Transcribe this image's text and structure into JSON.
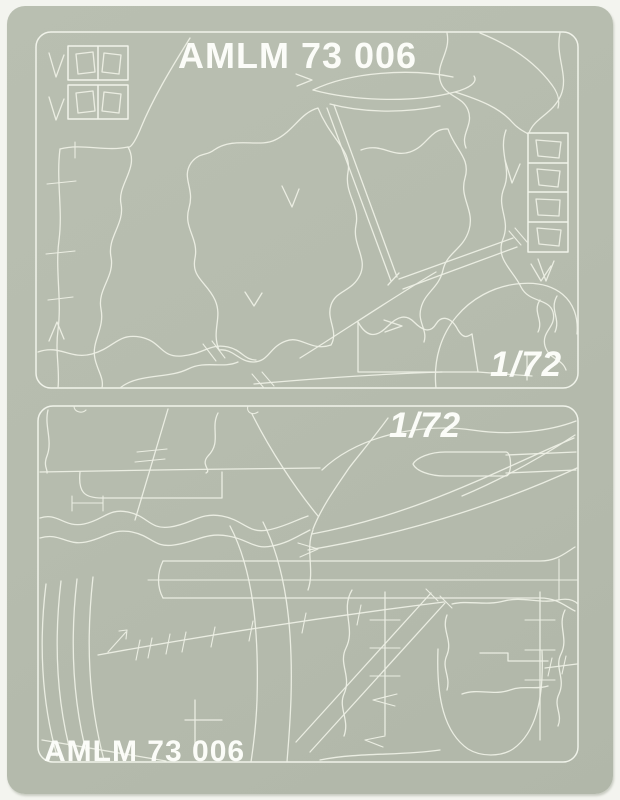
{
  "colors": {
    "page_background": "#f3f4ef",
    "sheet": "#b6bcae",
    "cut_line": "#edefe5",
    "text": "#fbfcf8"
  },
  "sheet": {
    "header_title": "AMLM 73 006",
    "top_panel": {
      "scale_label": "1/72"
    },
    "bottom_panel": {
      "scale_label": "1/72",
      "footer_title": "AMLM 73 006"
    }
  }
}
